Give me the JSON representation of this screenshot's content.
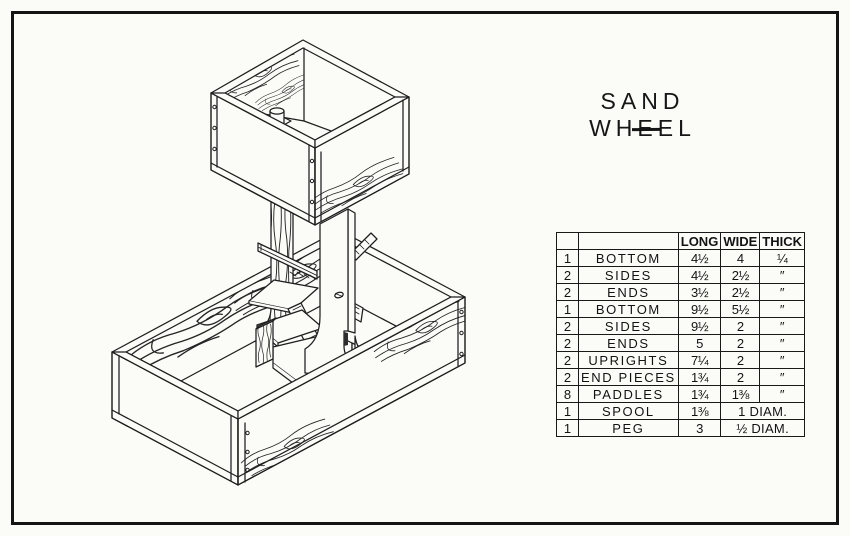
{
  "title": {
    "text": "SAND WHEEL"
  },
  "parts_table": {
    "headers": [
      "LONG",
      "WIDE",
      "THICK"
    ],
    "rows": [
      {
        "qty": "1",
        "name": "BOTTOM",
        "long": "4½",
        "wide": "4",
        "thick": "¼"
      },
      {
        "qty": "2",
        "name": "SIDES",
        "long": "4½",
        "wide": "2½",
        "thick": "″"
      },
      {
        "qty": "2",
        "name": "ENDS",
        "long": "3½",
        "wide": "2½",
        "thick": "″"
      },
      {
        "qty": "1",
        "name": "BOTTOM",
        "long": "9½",
        "wide": "5½",
        "thick": "″"
      },
      {
        "qty": "2",
        "name": "SIDES",
        "long": "9½",
        "wide": "2",
        "thick": "″"
      },
      {
        "qty": "2",
        "name": "ENDS",
        "long": "5",
        "wide": "2",
        "thick": "″"
      },
      {
        "qty": "2",
        "name": "UPRIGHTS",
        "long": "7¼",
        "wide": "2",
        "thick": "″"
      },
      {
        "qty": "2",
        "name": "END PIECES",
        "long": "1¾",
        "wide": "2",
        "thick": "″"
      },
      {
        "qty": "8",
        "name": "PADDLES",
        "long": "1¾",
        "wide": "1⅜",
        "thick": "″"
      },
      {
        "qty": "1",
        "name": "SPOOL",
        "long": "1⅜",
        "merged": "1 DIAM."
      },
      {
        "qty": "1",
        "name": "PEG",
        "long": "3",
        "merged": "½ DIAM."
      }
    ]
  },
  "colors": {
    "line": "#1e1e1e",
    "paper": "#fbfbf8"
  }
}
